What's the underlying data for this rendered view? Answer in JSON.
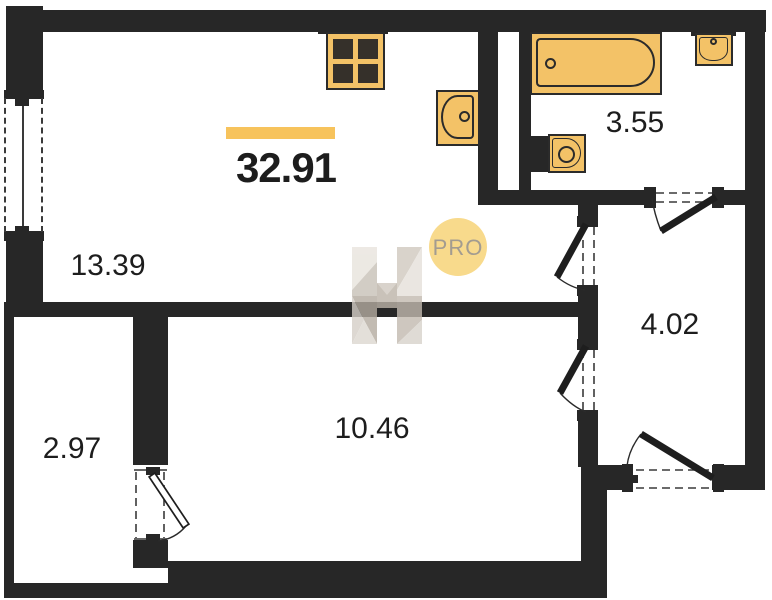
{
  "floorplan": {
    "total_area": "32.91",
    "rooms": [
      {
        "name": "living-kitchen",
        "area": "13.39"
      },
      {
        "name": "bathroom",
        "area": "3.55"
      },
      {
        "name": "hallway",
        "area": "4.02"
      },
      {
        "name": "bedroom",
        "area": "10.46"
      },
      {
        "name": "balcony",
        "area": "2.97"
      }
    ],
    "fixtures": [
      "stove",
      "kitchen-sink",
      "bathtub",
      "bathroom-sink",
      "toilet"
    ],
    "watermark": {
      "label": "PRO"
    },
    "colors": {
      "wall": "#272727",
      "fixture-fill": "#F3C267",
      "fixture-stroke": "#2B2B2B",
      "accent-bar": "#F7C35C",
      "watermark-circle": "#F8DA8C",
      "watermark-text": "#A39C90",
      "label-text": "#1D1D1D"
    }
  }
}
